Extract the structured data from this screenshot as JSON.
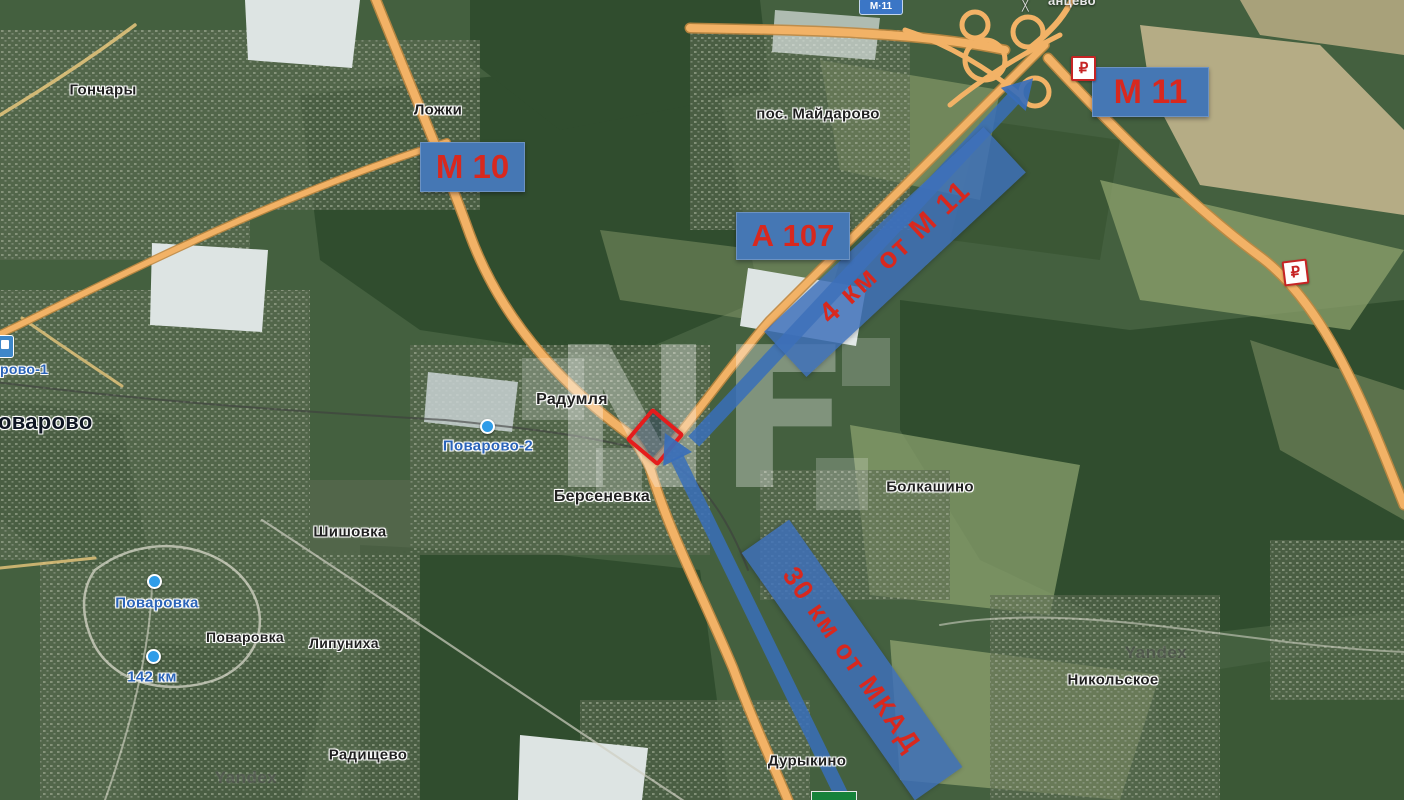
{
  "map": {
    "provider_watermark": "Yandex",
    "watermark_logo": "NF",
    "ruble_symbol": "₽",
    "road_badges": [
      {
        "label": "М 10"
      },
      {
        "label": "А 107"
      },
      {
        "label": "М 11"
      }
    ],
    "small_road_badge": "М·11",
    "distance_banners": [
      {
        "label": "4 км от М 11"
      },
      {
        "label": "30 км от МКАД"
      }
    ],
    "place_labels": [
      "Гончары",
      "Ложки",
      "пос. Майдарово",
      "Радумля",
      "Берсеневка",
      "Шишовка",
      "Болкашино",
      "Никольское",
      "Поваровка",
      "Липуниха",
      "Радищево",
      "Дурыкино"
    ],
    "blue_labels": [
      "Поварово-2",
      "рово-1",
      "Поваровка",
      "142 км"
    ],
    "town_label_partial": "оварово",
    "top_edge_label_partial": "анцево",
    "colors": {
      "badge_blue": "#4577b4",
      "badge_text_red": "#d8281e",
      "banner_blue": "#3e70ba",
      "plot_outline_red": "#e51c1c",
      "highway_orange": "#f2b266"
    }
  }
}
